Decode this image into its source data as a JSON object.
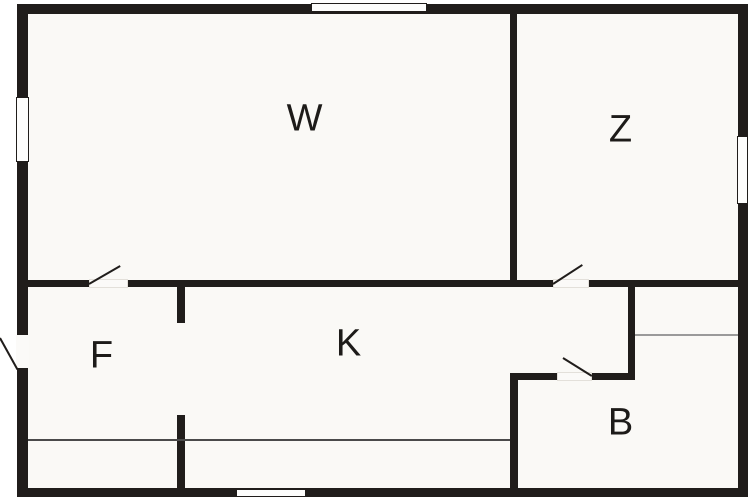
{
  "floor_plan": {
    "title": "floor-plan",
    "rooms": [
      {
        "id": "w",
        "label": "W"
      },
      {
        "id": "z",
        "label": "Z"
      },
      {
        "id": "f",
        "label": "F"
      },
      {
        "id": "k",
        "label": "K"
      },
      {
        "id": "b",
        "label": "B"
      }
    ],
    "colors": {
      "wall": "#201d1b",
      "floor": "#faf9f6",
      "background": "#ffffff",
      "window_fill": "#fdfdfc",
      "thin_line_dark": "#4a4a4a",
      "thin_line_light": "#9a9a9a"
    }
  }
}
